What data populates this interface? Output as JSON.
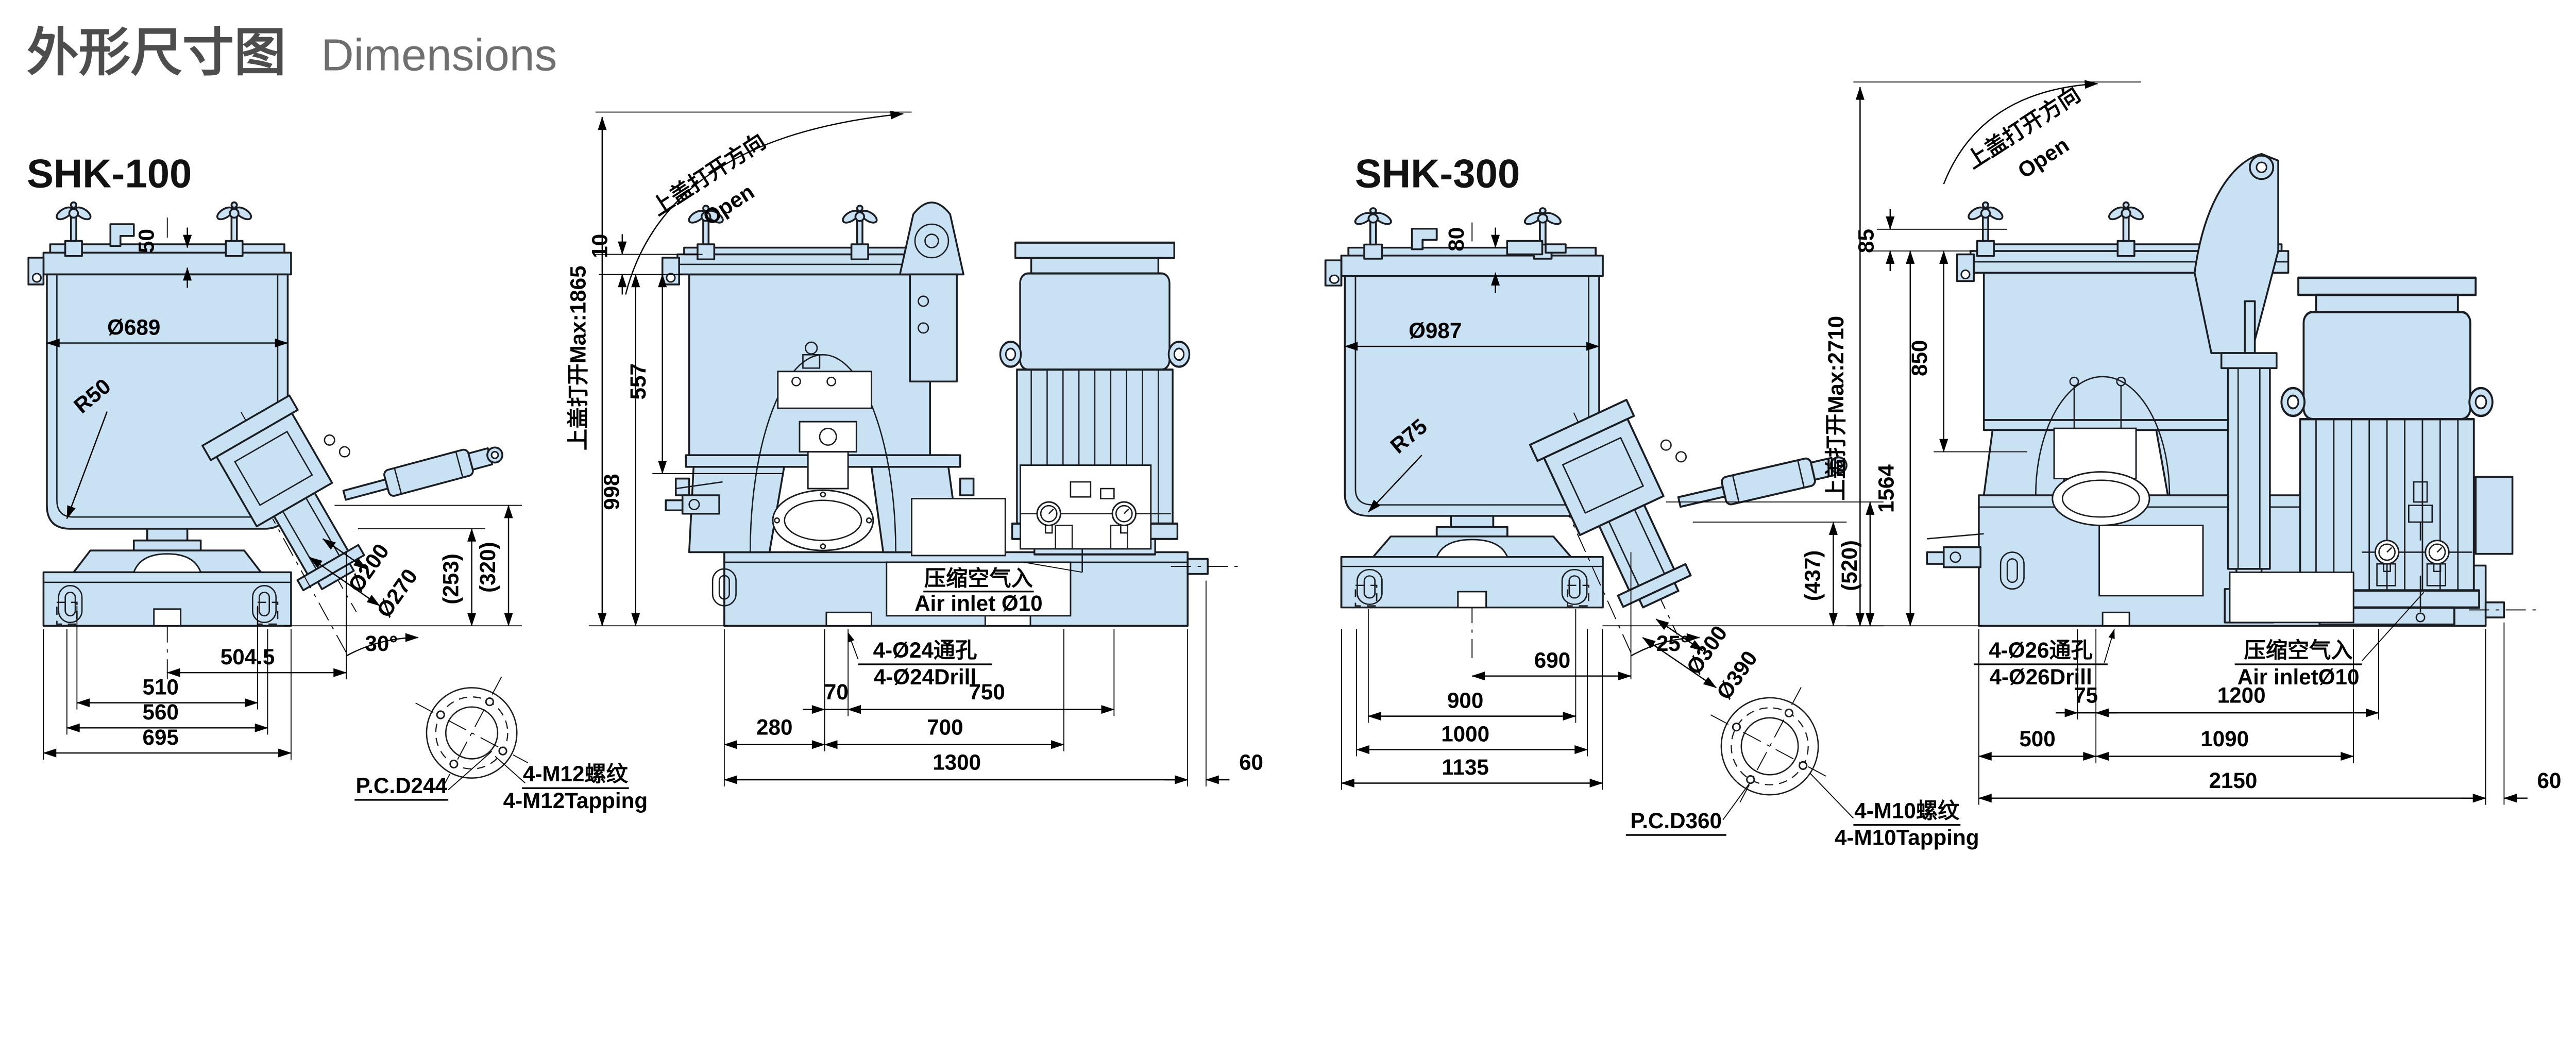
{
  "page": {
    "title_zh": "外形尺寸图",
    "title_en": "Dimensions"
  },
  "colors": {
    "body_fill": "#c9e2f3",
    "outline": "#1a1d21",
    "title_zh": "#4d4d4d",
    "title_en": "#6f6f6f"
  },
  "shk100": {
    "name": "SHK-100",
    "front": {
      "lid_offset": "50",
      "bowl_dia": "Ø689",
      "corner_radius": "R50",
      "outlet_dia": "Ø200",
      "outlet_flange_dia": "Ø270",
      "outlet_height_1": "(253)",
      "outlet_height_2": "(320)",
      "chute_angle": "30°",
      "center_to_outlet": "504.5",
      "width_1": "510",
      "width_2": "560",
      "width_3": "695",
      "pcd": "P.C.D244",
      "tap_zh": "4-M12螺纹",
      "tap_en": "4-M12Tapping"
    },
    "side": {
      "open_dir_zh": "上盖打开方向",
      "open_dir_en": "Open",
      "open_max": "上盖打开Max:1865",
      "lid_dim": "10",
      "height_1": "557",
      "height_2": "998",
      "air_zh": "压缩空气入",
      "air_en": "Air inlet Ø10",
      "holes_zh": "4-Ø24通孔",
      "holes_en": "4-Ø24Drill",
      "len_1": "70",
      "len_2": "750",
      "len_3": "280",
      "len_4": "700",
      "len_5": "1300",
      "len_6": "60"
    }
  },
  "shk300": {
    "name": "SHK-300",
    "front": {
      "lid_offset": "80",
      "bowl_dia": "Ø987",
      "corner_radius": "R75",
      "outlet_dia": "Ø300",
      "outlet_flange_dia": "Ø390",
      "outlet_height_1": "(437)",
      "outlet_height_2": "(520)",
      "chute_angle": "25°",
      "center_to_outlet": "690",
      "width_1": "900",
      "width_2": "1000",
      "width_3": "1135",
      "pcd": "P.C.D360",
      "tap_zh": "4-M10螺纹",
      "tap_en": "4-M10Tapping"
    },
    "side": {
      "open_dir_zh": "上盖打开方向",
      "open_dir_en": "Open",
      "open_max": "上盖打开Max:2710",
      "lid_dim": "85",
      "height_1": "850",
      "height_2": "1564",
      "air_zh": "压缩空气入",
      "air_en": "Air inletØ10",
      "holes_zh": "4-Ø26通孔",
      "holes_en": "4-Ø26Drill",
      "len_1": "75",
      "len_2": "1200",
      "len_3": "500",
      "len_4": "1090",
      "len_5": "2150",
      "len_6": "60"
    }
  }
}
